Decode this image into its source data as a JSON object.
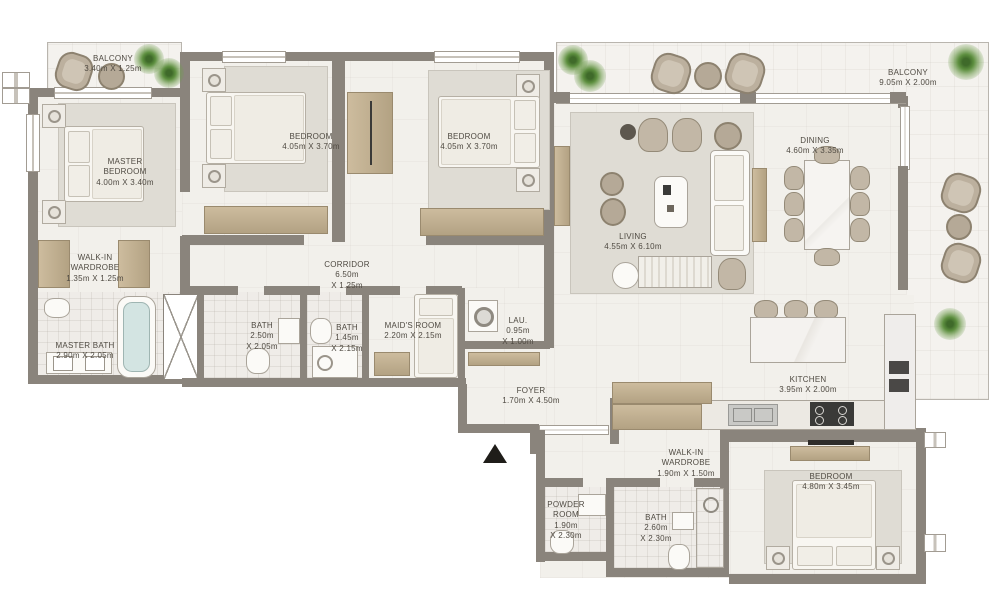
{
  "plan": {
    "type": "apartment-floor-plan",
    "rooms": [
      {
        "id": "balcony-1",
        "name": "BALCONY",
        "dims": "3.40m X 1.25m"
      },
      {
        "id": "master-bedroom",
        "name": [
          "MASTER",
          "BEDROOM"
        ],
        "dims": "4.00m X 3.40m"
      },
      {
        "id": "bedroom-2",
        "name": "BEDROOM",
        "dims": "4.05m X 3.70m"
      },
      {
        "id": "bedroom-3",
        "name": "BEDROOM",
        "dims": "4.05m X 3.70m"
      },
      {
        "id": "walk-in-wardrobe-1",
        "name": [
          "WALK-IN",
          "WARDROBE"
        ],
        "dims": "1.35m X 1.25m"
      },
      {
        "id": "master-bath",
        "name": "MASTER BATH",
        "dims": "2.90m X 2.05m"
      },
      {
        "id": "corridor",
        "name": "CORRIDOR",
        "dims": [
          "6.50m",
          "X 1.25m"
        ]
      },
      {
        "id": "bath-1",
        "name": "BATH",
        "dims": [
          "2.50m",
          "X 2.05m"
        ]
      },
      {
        "id": "bath-2",
        "name": "BATH",
        "dims": [
          "1.45m",
          "X 2.15m"
        ]
      },
      {
        "id": "maids-room",
        "name": "MAID'S ROOM",
        "dims": "2.20m X 2.15m"
      },
      {
        "id": "laundry",
        "name": "LAU.",
        "dims": [
          "0.95m",
          "X 1.00m"
        ]
      },
      {
        "id": "foyer",
        "name": "FOYER",
        "dims": "1.70m X 4.50m"
      },
      {
        "id": "living",
        "name": "LIVING",
        "dims": "4.55m X 6.10m"
      },
      {
        "id": "dining",
        "name": "DINING",
        "dims": "4.60m X 3.35m"
      },
      {
        "id": "balcony-2",
        "name": "BALCONY",
        "dims": "9.05m X 2.00m"
      },
      {
        "id": "kitchen",
        "name": "KITCHEN",
        "dims": "3.95m X 2.00m"
      },
      {
        "id": "walk-in-wardrobe-2",
        "name": [
          "WALK-IN",
          "WARDROBE"
        ],
        "dims": "1.90m X 1.50m"
      },
      {
        "id": "powder-room",
        "name": [
          "POWDER",
          "ROOM"
        ],
        "dims": [
          "1.90m",
          "X 2.30m"
        ]
      },
      {
        "id": "bath-3",
        "name": "BATH",
        "dims": [
          "2.60m",
          "X 2.30m"
        ]
      },
      {
        "id": "bedroom-4",
        "name": "BEDROOM",
        "dims": "4.80m X 3.45m"
      }
    ],
    "palette": {
      "wall": "#8a847c",
      "floor": "#f2f0eb",
      "balcony_floor": "#f4f2ee",
      "wood": "#c1b091",
      "rug": "#dfdcd4",
      "seat": "#bcb09e",
      "plant": "#5d8f3f",
      "tub": "#d3e4e2",
      "text": "#4f4a42",
      "appliance_dark": "#3a3a38",
      "entrance_marker": "#1f1d19"
    }
  }
}
